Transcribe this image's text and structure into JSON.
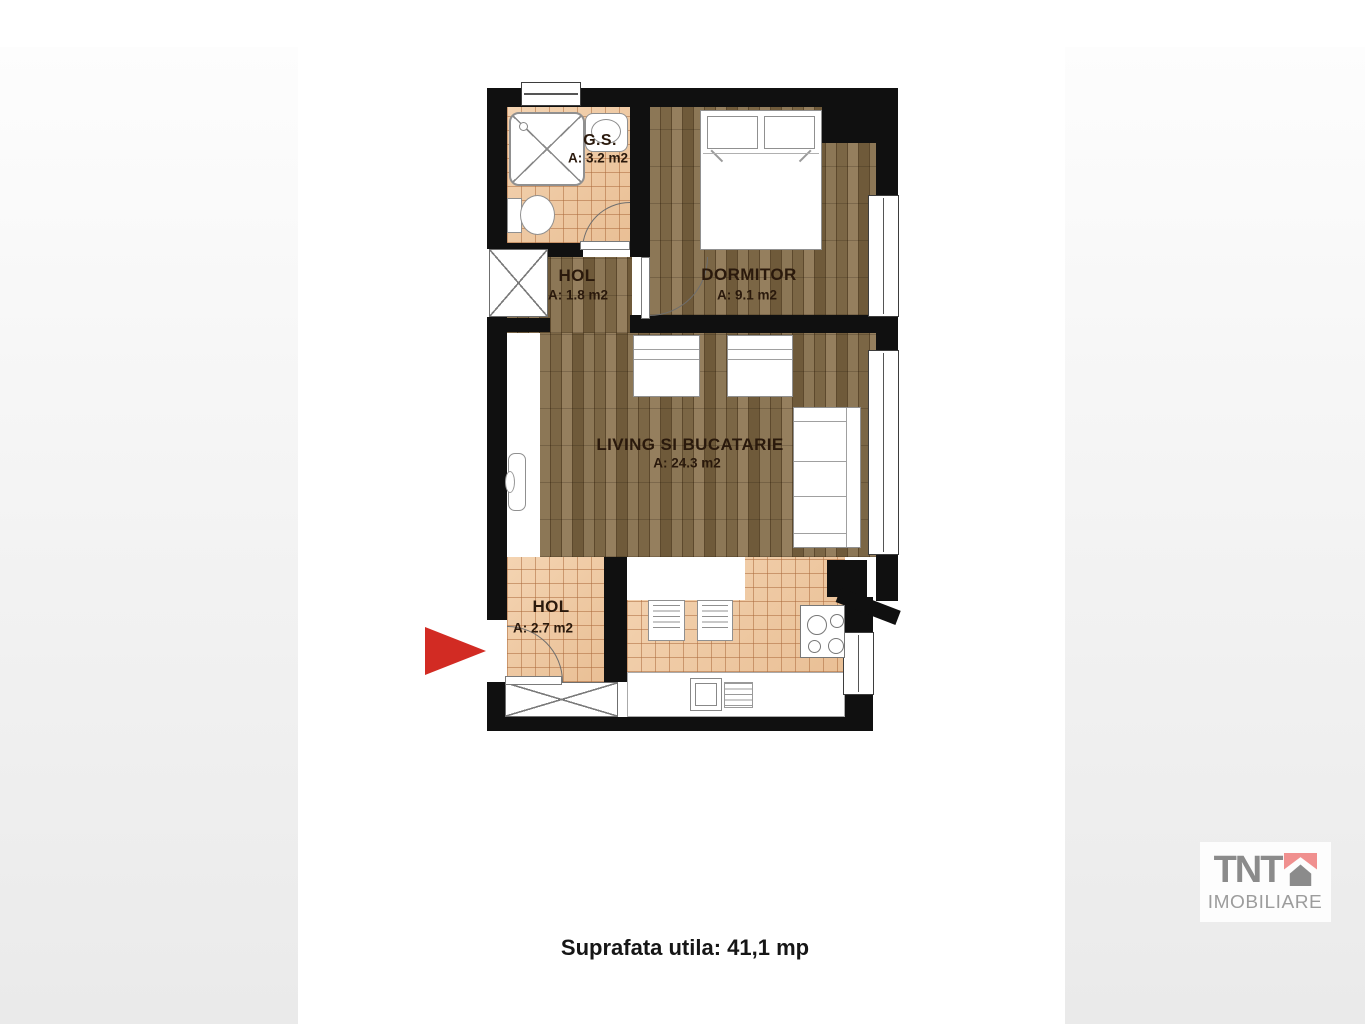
{
  "plan": {
    "rooms": [
      {
        "id": "gs",
        "name": "G.S.",
        "area": "A: 3.2 m2"
      },
      {
        "id": "hol1",
        "name": "HOL",
        "area": "A: 1.8 m2"
      },
      {
        "id": "dormitor",
        "name": "DORMITOR",
        "area": "A: 9.1 m2"
      },
      {
        "id": "living",
        "name": "LIVING SI BUCATARIE",
        "area": "A: 24.3 m2"
      },
      {
        "id": "hol2",
        "name": "HOL",
        "area": "A: 2.7 m2"
      }
    ],
    "colors": {
      "wall": "#101010",
      "wood_floor": "#7f6a48",
      "tile_floor": "#eec9a6",
      "room_label": "#2a190c",
      "entrance_arrow": "#d22b23"
    }
  },
  "caption": {
    "text": "Suprafata utila: 41,1 mp"
  },
  "logo": {
    "brand": "TNT",
    "subtitle": "IMOBILIARE",
    "brand_color": "#8b8b8b",
    "mark_pink": "#f0908f",
    "mark_gray": "#8b8b8b",
    "card_background": "#fdfdfd"
  }
}
